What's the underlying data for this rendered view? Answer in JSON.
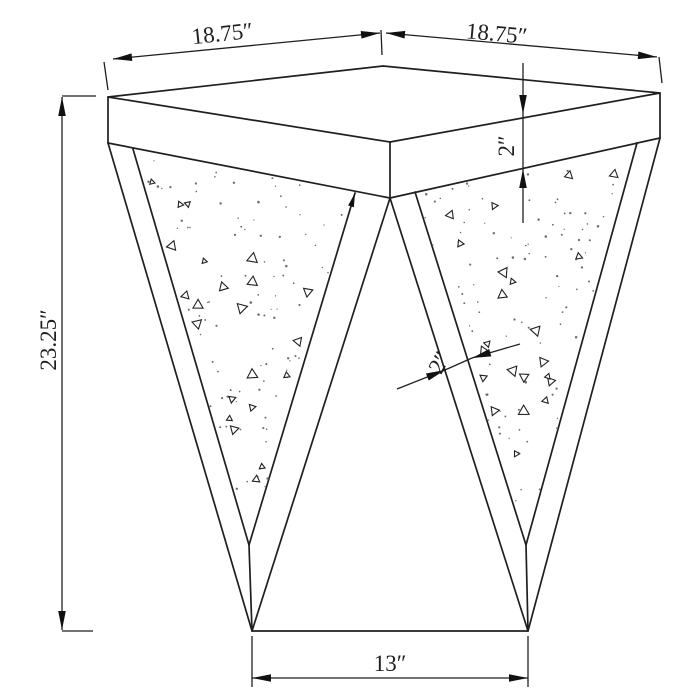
{
  "page": {
    "background": "#ffffff",
    "line_color": "#1f1f1f"
  },
  "labels": {
    "top_left_width": "18.75″",
    "top_right_depth": "18.75″",
    "top_thickness": "2″",
    "overall_height": "23.25″",
    "leg_frame_width": "2″",
    "base_width": "13″"
  },
  "texture": {
    "seed": 11,
    "dots_per_panel": 95,
    "triangles_per_panel": 22,
    "dot_color": "#6d6d6d",
    "triangle_stroke": "#222222"
  }
}
